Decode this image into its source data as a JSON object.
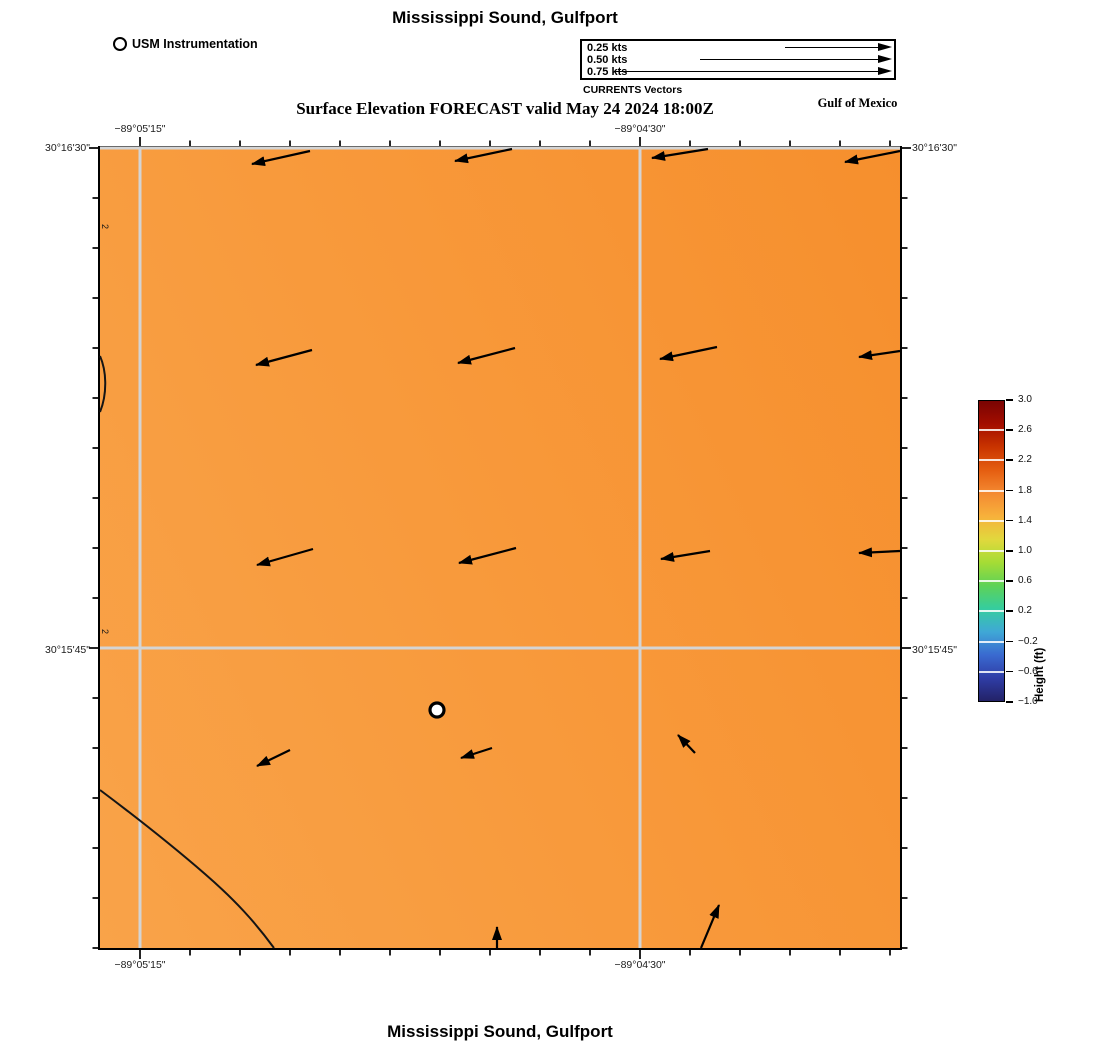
{
  "figure": {
    "title_top": "Mississippi Sound, Gulfport",
    "subtitle": "Surface Elevation FORECAST valid May 24 2024 18:00Z",
    "title_bottom": "Mississippi Sound, Gulfport",
    "area_label": "Gulf of Mexico"
  },
  "station_legend": {
    "label": "USM Instrumentation",
    "marker": "open-circle"
  },
  "vector_legend": {
    "caption": "CURRENTS Vectors",
    "items": [
      {
        "label": "0.25 kts",
        "arrow_px": 93
      },
      {
        "label": "0.50 kts",
        "arrow_px": 178
      },
      {
        "label": "0.75 kts",
        "arrow_px": 263
      }
    ]
  },
  "axes": {
    "lon_labels": [
      "−89°05'15\"",
      "−89°04'30\""
    ],
    "lat_labels": [
      "30°16'30\"",
      "30°15'45\""
    ]
  },
  "colorbar": {
    "title": "Height (ft)",
    "tick_labels": [
      "3.0",
      "2.6",
      "2.2",
      "1.8",
      "1.4",
      "1.0",
      "0.6",
      "0.2",
      "−0.2",
      "−0.6",
      "−1.0"
    ],
    "gradient": [
      "#7a0403",
      "#a30d00",
      "#c93400",
      "#e55e10",
      "#f48a32",
      "#f7b13b",
      "#e1d83d",
      "#a5dc35",
      "#5ed257",
      "#35cd9f",
      "#3fa8d6",
      "#3a6ad0",
      "#2f3da6",
      "#232267"
    ]
  },
  "layout": {
    "map_px": 800,
    "x_gridlines_px": [
      40,
      540
    ],
    "y_gridlines_px": [
      0,
      500
    ],
    "tick_step_px": 50,
    "grid_color": "#d4d4d4",
    "map_base_color": "#f89a3c",
    "colorbar_height_px": 302
  },
  "chart_data": {
    "type": "heatmap",
    "title": "Mississippi Sound, Gulfport",
    "subtitle": "Surface Elevation FORECAST valid May 24 2024 18:00Z",
    "region": "Mississippi Sound, Gulfport",
    "adjacent_water": "Gulf of Mexico",
    "field": "surface_elevation_ft",
    "field_approx_uniform_value_ft": 2.05,
    "value_range_ft": [
      -1.0,
      3.0
    ],
    "colorbar": {
      "label": "Height (ft)",
      "tick_values": [
        3.0,
        2.6,
        2.2,
        1.8,
        1.4,
        1.0,
        0.6,
        0.2,
        -0.2,
        -0.6,
        -1.0
      ],
      "range": [
        -1.0,
        3.0
      ]
    },
    "x_axis": {
      "tick_labels": [
        "−89°05'15\"",
        "−89°04'30\""
      ],
      "gridline_frac": [
        0.05,
        0.675
      ]
    },
    "y_axis": {
      "tick_labels": [
        "30°16'30\"",
        "30°15'45\""
      ],
      "gridline_frac": [
        0.0,
        0.625
      ]
    },
    "vector_scale_kts": [
      0.25,
      0.5,
      0.75
    ],
    "vectors_note": "surface current vectors ~0.2-0.35 kts flowing W to WSW over most of the domain; upward (N) flow near the southern edge",
    "contour_level_ft": 2,
    "contours": [
      {
        "level_ft": 2,
        "path": "M 0,642 C 40,672 75,700 105,726 C 135,752 155,774 174,800"
      },
      {
        "level_ft": 2,
        "path": "M 0,208 C 7,224 7,247 0,264"
      }
    ],
    "edge_labels": [
      {
        "text": "2",
        "x": 2,
        "y": 76
      },
      {
        "text": "2",
        "x": 2,
        "y": 481
      }
    ],
    "station": {
      "x": 337,
      "y": 562,
      "label": "USM Instrumentation"
    },
    "vectors": [
      {
        "x1": 210,
        "y1": 3,
        "x2": 152,
        "y2": 16
      },
      {
        "x1": 412,
        "y1": 1,
        "x2": 355,
        "y2": 13
      },
      {
        "x1": 608,
        "y1": 1,
        "x2": 552,
        "y2": 10
      },
      {
        "x1": 800,
        "y1": 3,
        "x2": 745,
        "y2": 14
      },
      {
        "x1": 212,
        "y1": 202,
        "x2": 156,
        "y2": 217
      },
      {
        "x1": 415,
        "y1": 200,
        "x2": 358,
        "y2": 215
      },
      {
        "x1": 617,
        "y1": 199,
        "x2": 560,
        "y2": 211
      },
      {
        "x1": 800,
        "y1": 203,
        "x2": 759,
        "y2": 209
      },
      {
        "x1": 213,
        "y1": 401,
        "x2": 157,
        "y2": 417
      },
      {
        "x1": 416,
        "y1": 400,
        "x2": 359,
        "y2": 415
      },
      {
        "x1": 610,
        "y1": 403,
        "x2": 561,
        "y2": 411
      },
      {
        "x1": 800,
        "y1": 403,
        "x2": 759,
        "y2": 405
      },
      {
        "x1": 190,
        "y1": 602,
        "x2": 157,
        "y2": 618
      },
      {
        "x1": 392,
        "y1": 600,
        "x2": 361,
        "y2": 610
      },
      {
        "x1": 595,
        "y1": 605,
        "x2": 578,
        "y2": 587
      },
      {
        "x1": 397,
        "y1": 800,
        "x2": 397,
        "y2": 779
      },
      {
        "x1": 601,
        "y1": 800,
        "x2": 619,
        "y2": 757
      }
    ]
  }
}
